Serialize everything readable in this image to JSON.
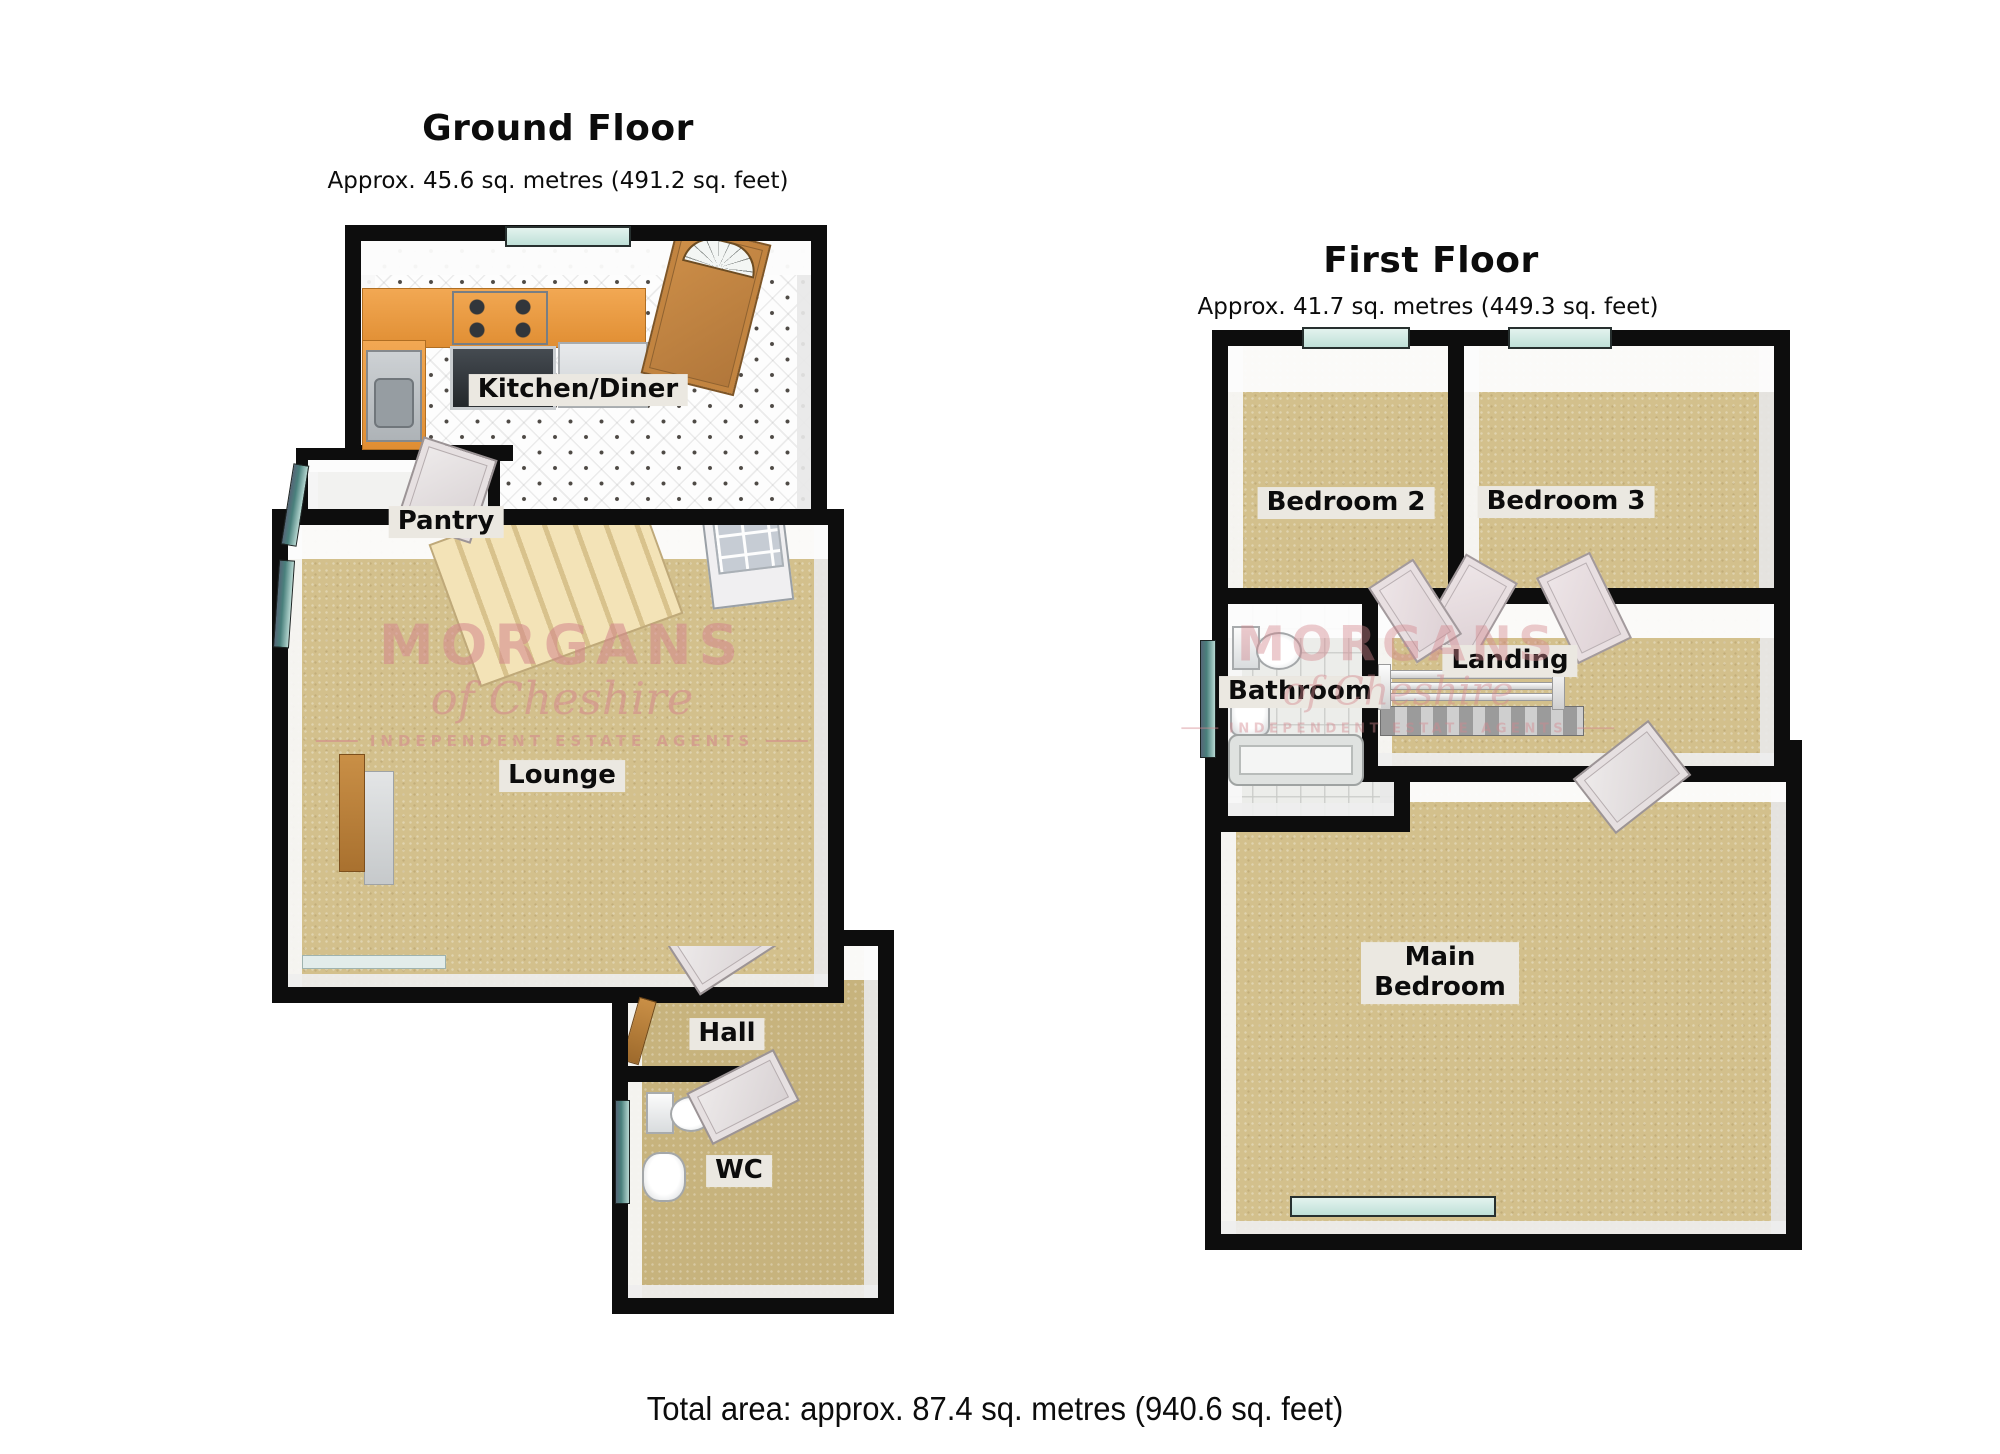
{
  "ground_floor": {
    "title": "Ground Floor",
    "subtitle": "Approx. 45.6 sq. metres (491.2 sq. feet)",
    "rooms": {
      "kitchen": "Kitchen/Diner",
      "pantry": "Pantry",
      "lounge": "Lounge",
      "hall": "Hall",
      "wc": "WC"
    }
  },
  "first_floor": {
    "title": "First Floor",
    "subtitle": "Approx. 41.7 sq. metres (449.3 sq. feet)",
    "rooms": {
      "bedroom2": "Bedroom 2",
      "bedroom3": "Bedroom 3",
      "bathroom": "Bathroom",
      "landing": "Landing",
      "main_bedroom": "Main Bedroom"
    }
  },
  "watermark": {
    "name": "MORGANS",
    "tagline": "of Cheshire",
    "subtext": "INDEPENDENT ESTATE AGENTS"
  },
  "footer": {
    "total_area": "Total area: approx. 87.4 sq. metres (940.6 sq. feet)"
  },
  "palette": {
    "wall": "#0d0d0d",
    "carpet": "#d3c08c",
    "tile_floor": "#fdfdfd",
    "counter": "#e9973f",
    "stairs": "#f0ddab",
    "door_wood": "#bc7f3c",
    "window_glass": "#d6ece7",
    "window_dark": "#49807c",
    "label_bg": "#ebe8e1",
    "watermark_pink": "#d4868d"
  }
}
